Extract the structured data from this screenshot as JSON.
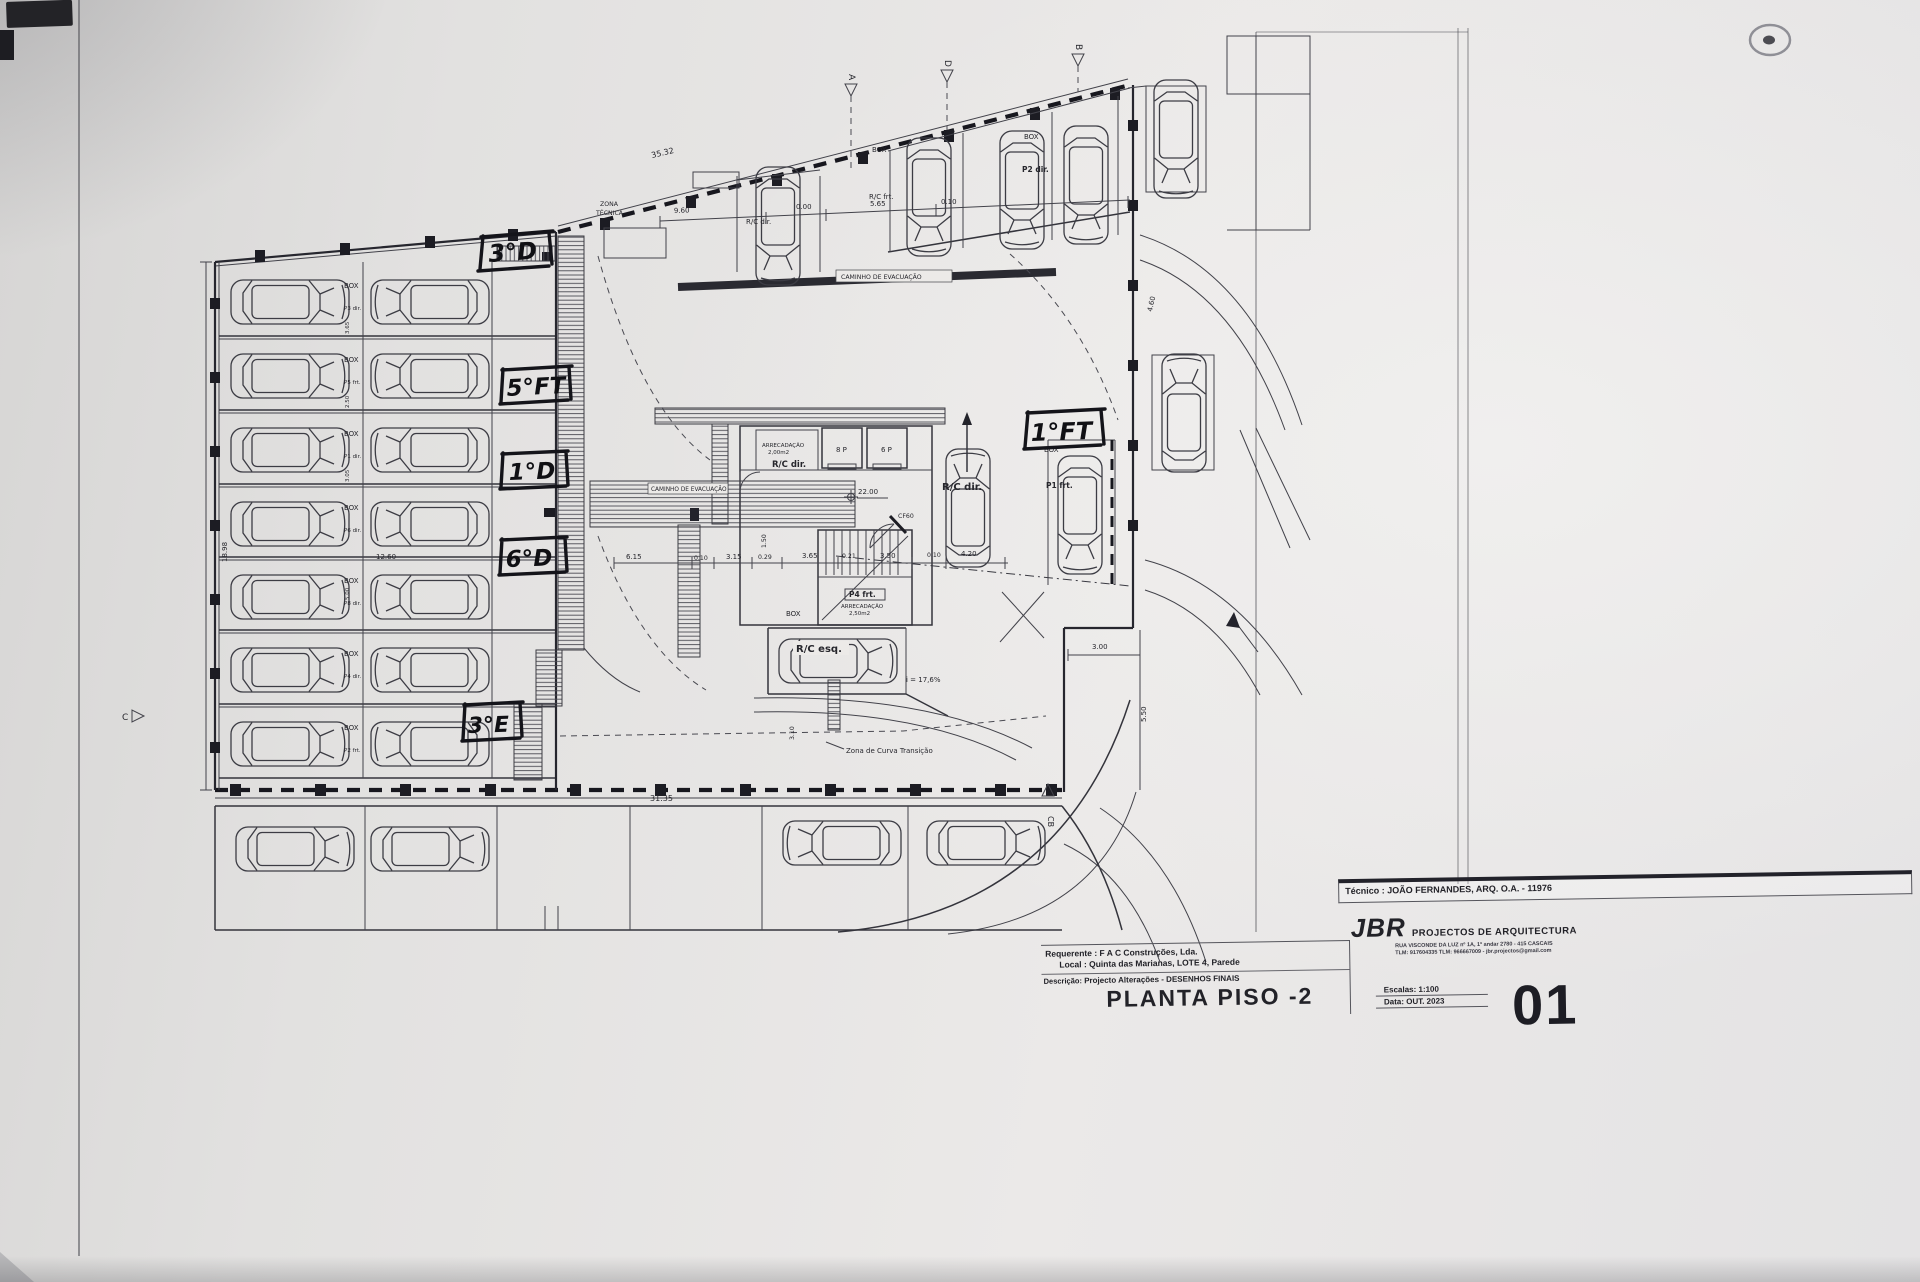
{
  "plan": {
    "handwritten": {
      "h1": "3°D",
      "h2": "5°FT",
      "h3": "1°D",
      "h4": "6°D",
      "h5": "3°E",
      "h6": "1°FT"
    },
    "labels": {
      "zona1": "ZONA",
      "zona2": "TÉCNICA",
      "caminho": "CAMINHO DE EVACUAÇÃO",
      "curva": "Zona de Curva Transição",
      "slope": "i = 17,6%",
      "box": "BOX",
      "rcdir": "R/C dir.",
      "rcfrt": "R/C frt.",
      "rcesq": "R/C esq.",
      "p2dir": "P2 dir.",
      "p1frt": "P1 frt.",
      "p4frt": "P4 frt.",
      "arrec": "ARRECADAÇÃO",
      "arrec_a": "2,00m2",
      "arrec_b": "2,50m2",
      "e8": "8 P",
      "e6": "6 P",
      "lvl": "22.00",
      "cf": "CF60"
    },
    "stalls": [
      {
        "box": "BOX",
        "code": "P3 dir."
      },
      {
        "box": "BOX",
        "code": "P5 frt."
      },
      {
        "box": "BOX",
        "code": "P1 dir."
      },
      {
        "box": "BOX",
        "code": "P6 dir."
      },
      {
        "box": "BOX",
        "code": "P8 dir."
      },
      {
        "box": "BOX",
        "code": "P4 dir."
      },
      {
        "box": "BOX",
        "code": "P2 frt."
      }
    ],
    "dims": [
      "35.32",
      "9.60",
      "0.00",
      "5.65",
      "0.10",
      "18.98",
      "12.60",
      "31.35",
      "6.15",
      "0.10",
      "3.15",
      "0.29",
      "3.65",
      "0.21",
      "3.50",
      "0.10",
      "4.20",
      "3.00",
      "5.50",
      "3.10",
      "1.50",
      "4.60",
      "3.65",
      "2.50",
      "3.05",
      "5.00"
    ],
    "markers": {
      "a": "A",
      "b": "B",
      "c": "C",
      "d": "D",
      "cb": "CB"
    }
  },
  "title_block": {
    "tecnico": "Técnico : JOÃO FERNANDES, ARQ.   O.A. - 11976",
    "requerente": "Requerente : F A C Construções, Lda.",
    "local": "Local : Quinta das Marianas, LOTE 4, Parede",
    "descricao_label": "Descrição:",
    "descricao": "Projecto Alterações - DESENHOS FINAIS",
    "plan_title": "PLANTA PISO -2",
    "firm": "JBR",
    "firm_rest": "PROJECTOS DE ARQUITECTURA",
    "address1": "RUA VISCONDE DA LUZ nº 1A, 1º andar   2780 - 415   CASCAIS",
    "address2": "TLM: 917604335  TLM: 966667009  -  jbr.projectos@gmail.com",
    "escalas_label": "Escalas:  1:100",
    "data_label": "Data:  OUT.  2023",
    "sheet": "01"
  }
}
